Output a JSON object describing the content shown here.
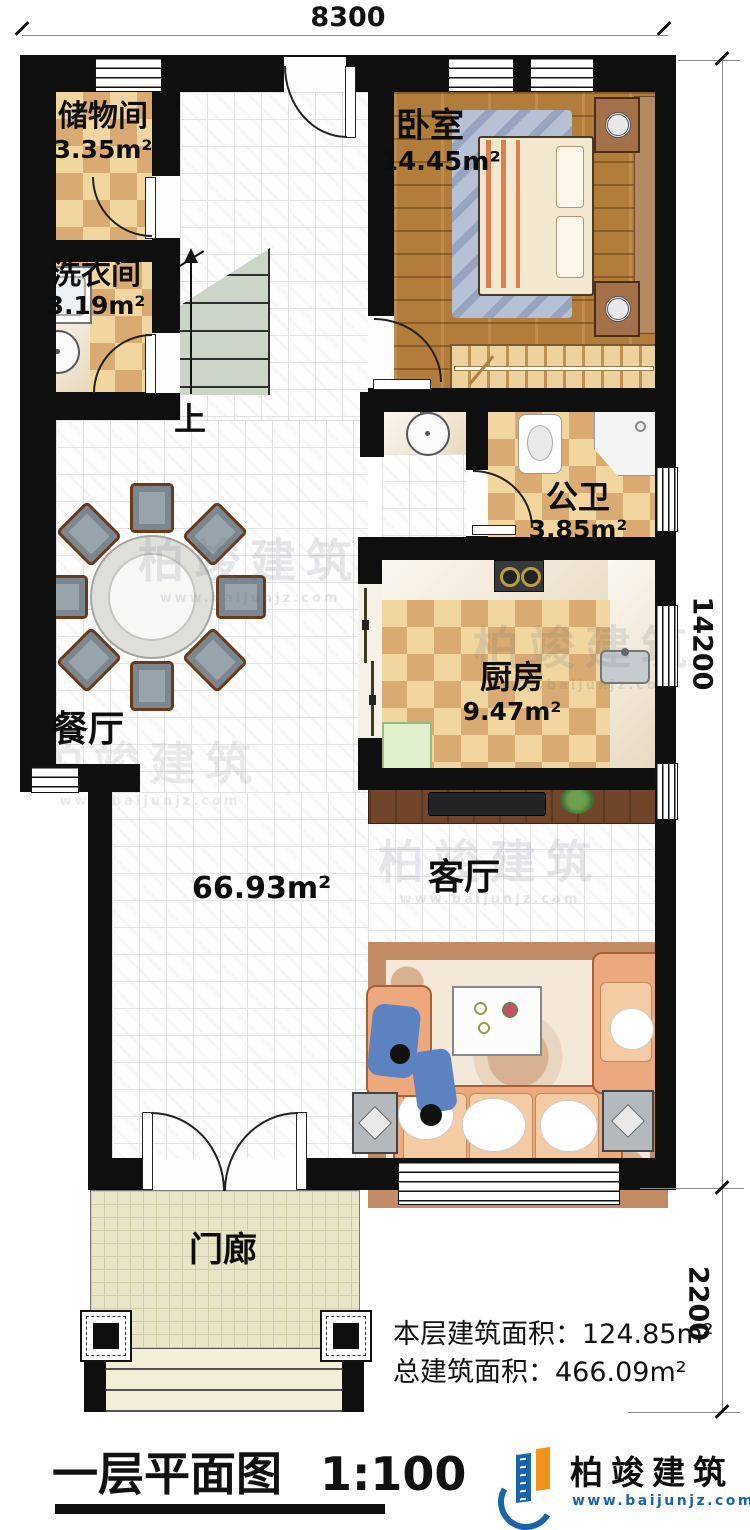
{
  "dimensions": {
    "top": "8300",
    "right_main": "14200",
    "right_porch": "2200"
  },
  "rooms": {
    "storage": {
      "name": "储物间",
      "area": "3.35m²"
    },
    "laundry": {
      "name": "洗衣间",
      "area": "3.19m²"
    },
    "bedroom": {
      "name": "卧室",
      "area": "14.45m²"
    },
    "bathroom": {
      "name": "公卫",
      "area": "3.85m²"
    },
    "kitchen": {
      "name": "厨房",
      "area": "9.47m²"
    },
    "dining": {
      "name": "餐厅"
    },
    "living": {
      "name": "客厅"
    },
    "porch": {
      "name": "门廊"
    },
    "hall": {
      "area": "66.93m²"
    },
    "stairs": {
      "label": "上"
    }
  },
  "summary": {
    "floor_area_label": "本层建筑面积：",
    "floor_area_value": "124.85m²",
    "total_area_label": "总建筑面积：",
    "total_area_value": "466.09m²"
  },
  "title_block": {
    "title": "一层平面图",
    "scale": "1:100"
  },
  "logo": {
    "company": "柏竣建筑",
    "website": "www.baijunjz.com"
  },
  "watermark": {
    "text": "柏竣建筑",
    "website": "www.baijunjz.com"
  },
  "colors": {
    "wall": "#0f0f0f",
    "checker_light": "#f1d6a0",
    "checker_dark": "#d9ab72",
    "wood": "#b27c3a",
    "brand_blue": "#1a63ad",
    "brand_orange": "#f0941d"
  }
}
